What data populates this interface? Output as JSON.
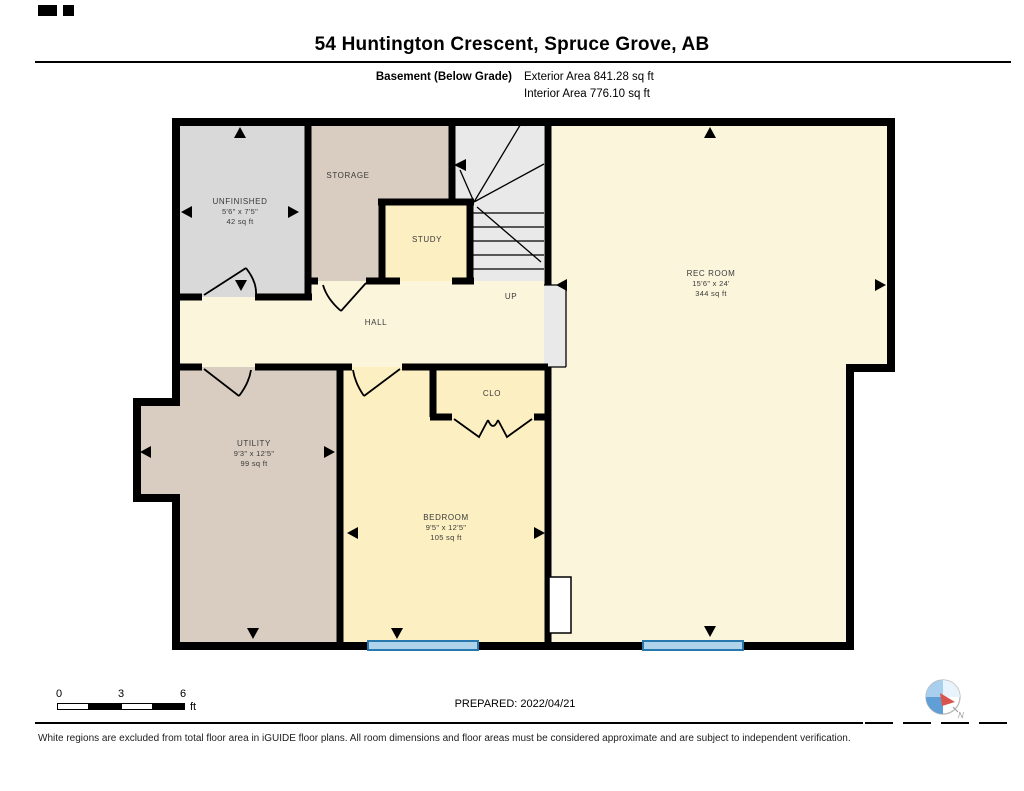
{
  "header": {
    "title": "54 Huntington Crescent, Spruce Grove, AB",
    "floor_label": "Basement (Below Grade)",
    "exterior_area": "Exterior Area 841.28 sq ft",
    "interior_area": "Interior Area 776.10 sq ft"
  },
  "rooms": {
    "unfinished": {
      "name": "UNFINISHED",
      "dims": "5'6\" x 7'5\"",
      "area": "42 sq ft"
    },
    "storage": {
      "name": "STORAGE"
    },
    "study": {
      "name": "STUDY"
    },
    "rec": {
      "name": "REC ROOM",
      "dims": "15'6\" x 24'",
      "area": "344 sq ft"
    },
    "hall": {
      "name": "HALL"
    },
    "clo": {
      "name": "CLO"
    },
    "utility": {
      "name": "UTILITY",
      "dims": "9'3\" x 12'5\"",
      "area": "99 sq ft"
    },
    "bedroom": {
      "name": "BEDROOM",
      "dims": "9'5\" x 12'5\"",
      "area": "105 sq ft"
    }
  },
  "stairs": {
    "direction_label": "UP"
  },
  "scale_bar": {
    "ticks": [
      "0",
      "3",
      "6"
    ],
    "unit": "ft"
  },
  "footer": {
    "prepared": "PREPARED: 2022/04/21",
    "disclaimer": "White regions are excluded from total floor area in iGUIDE floor plans. All room dimensions and floor areas must be considered approximate and are subject to independent verification."
  },
  "compass": {
    "north_label": "N"
  },
  "colors": {
    "wall": "#000000",
    "room_gray": "#d9d9d9",
    "room_tan": "#d8cdc0",
    "room_cream": "#fbf5dc",
    "room_yellow": "#fcefc2",
    "stairs_gray": "#e9e9e9",
    "window_fill": "#aed3ea",
    "window_stroke": "#2878b0",
    "feature_white": "#ffffff",
    "compass_light_blue": "#a9cfee",
    "compass_mid_blue": "#5f9fd6",
    "compass_pale_blue": "#e8f3fb",
    "compass_red": "#d9534f"
  }
}
